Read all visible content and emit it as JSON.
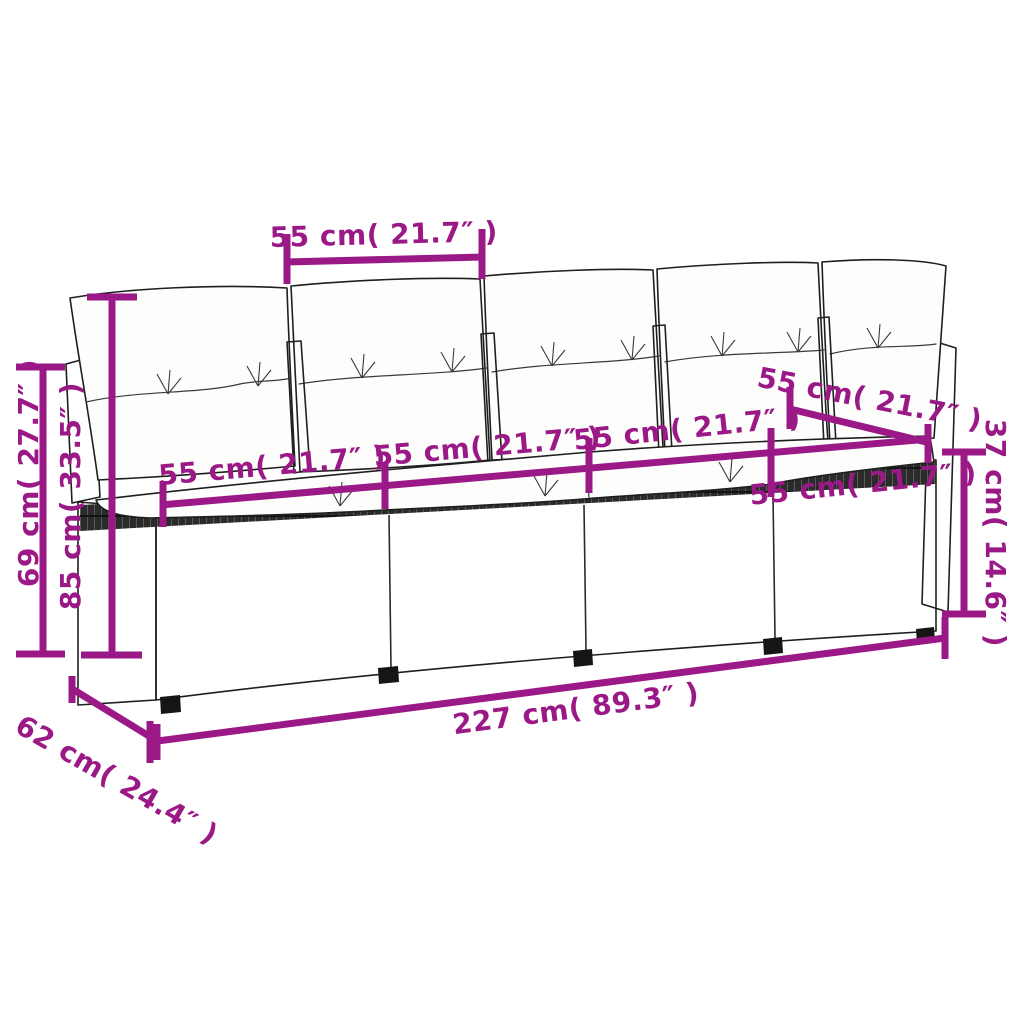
{
  "figure": {
    "subject": "rattan-garden-sofa-line-drawing",
    "style": "product-dimension-diagram",
    "seats": 4,
    "back_cushions": 5
  },
  "colors": {
    "dimension_annotation": "#9B1987",
    "outline": "#1F1F1F",
    "background": "#FFFFFF"
  },
  "measurements": {
    "cushion_width_top": "55 cm( 21.7″ )",
    "seat1_width": "55 cm( 21.7″ )",
    "seat2_width": "55 cm( 21.7″ )",
    "seat3_width": "55 cm( 21.7″ )",
    "seat4_width": "55 cm( 21.7″ )",
    "side_depth": "55 cm( 21.7″ )",
    "backrest_height": "69 cm( 27.7″ )",
    "total_height": "85 cm( 33.5″ )",
    "seat_height": "37 cm( 14.6″ )",
    "total_length": "227 cm( 89.3″ )",
    "base_depth": "62 cm( 24.4″ )"
  }
}
